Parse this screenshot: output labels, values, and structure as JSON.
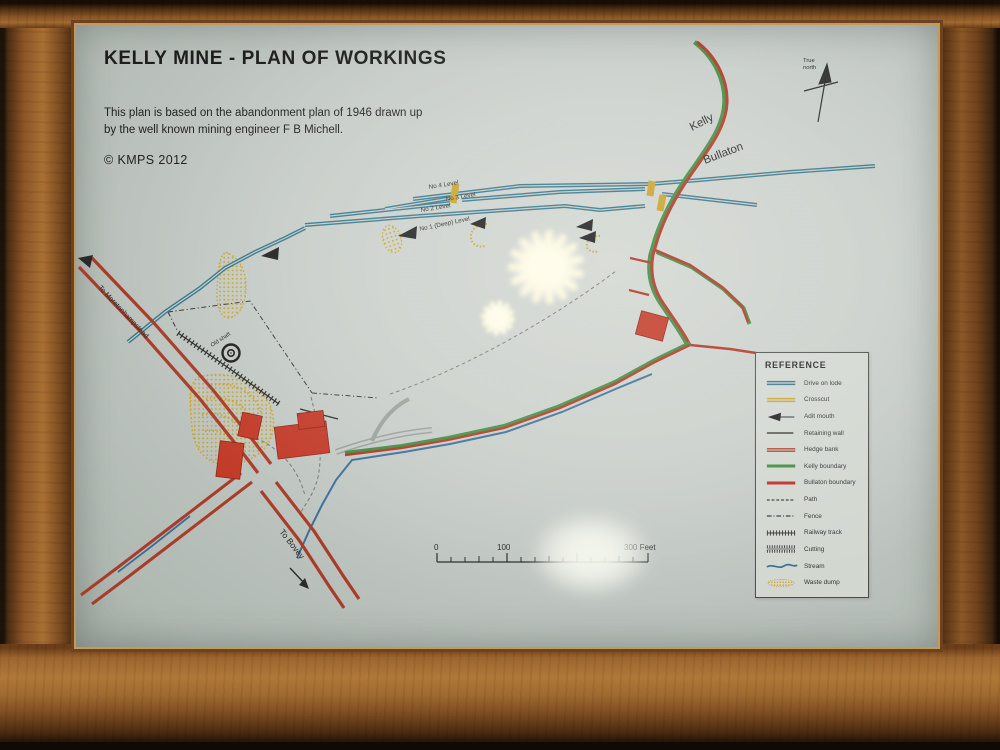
{
  "map": {
    "title": "KELLY MINE - PLAN OF WORKINGS",
    "subtitle_lines": [
      "This plan is based on the abandonment plan of 1946 drawn up",
      "by the well known mining engineer F B Michell."
    ],
    "copyright": "© KMPS 2012",
    "north_arrow": {
      "label_line1": "True",
      "label_line2": "north"
    },
    "labels": {
      "kelly": "Kelly",
      "bullaton": "Bullaton",
      "to_moretonhampstead": "To Moretonhampstead",
      "to_bovey": "To Bovey",
      "old_shaft": "Old shaft"
    },
    "level_labels": [
      "No 4 Level",
      "No 3 Level",
      "No 2 Level",
      "No 1 (Deep) Level"
    ],
    "scale_bar": {
      "labels": [
        "0",
        "100",
        "300 Feet"
      ]
    },
    "legend": {
      "title": "REFERENCE",
      "items": [
        {
          "label": "Drive on lode",
          "color": "#33758a"
        },
        {
          "label": "Crosscut",
          "color": "#c9a227"
        },
        {
          "label": "Adit mouth",
          "color": "#1e1e1e"
        },
        {
          "label": "Retaining wall",
          "color": "#1e1e1e"
        },
        {
          "label": "Hedge bank",
          "color": "#a83c28"
        },
        {
          "label": "Kelly boundary",
          "color": "#3e8c3e"
        },
        {
          "label": "Bullaton boundary",
          "color": "#c22c24"
        },
        {
          "label": "Path",
          "color": "#3a3a3a"
        },
        {
          "label": "Fence",
          "color": "#3a3a3a"
        },
        {
          "label": "Railway track",
          "color": "#3a3a3a"
        },
        {
          "label": "Cutting",
          "color": "#3a3a3a"
        },
        {
          "label": "Stream",
          "color": "#3a6d9a"
        },
        {
          "label": "Waste dump",
          "color": "#c9a227"
        }
      ]
    },
    "colors": {
      "paper": "#c5cbc6",
      "frame_wood": "#8a5426",
      "drive_on_lode": "#33758a",
      "crosscut": "#c9a227",
      "hedge_bank": "#a83c28",
      "kelly_boundary": "#3e8c3e",
      "bullaton_boundary": "#c22c24",
      "stream": "#3a6d9a",
      "building": "#c23a28",
      "waste_dump": "#c9a227"
    }
  }
}
